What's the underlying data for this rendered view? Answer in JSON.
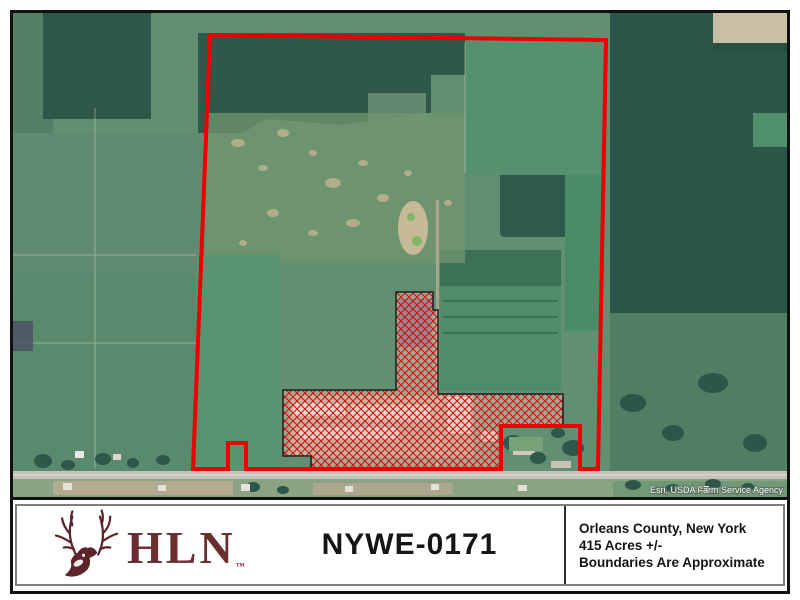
{
  "map": {
    "attribution": "Esri, USDA Farm Service Agency",
    "boundary_color": "#ee0000",
    "hatch_line_color": "#c51414",
    "hatch_fill_tint": "#f3c0ae",
    "hatch_outline_color": "#1c1c1c"
  },
  "footer": {
    "logo": {
      "text": "HLN",
      "trademark": "™",
      "color": "#5c2429",
      "deer_icon": "whitetail-buck-head"
    },
    "title": "NYWE-0171",
    "details": {
      "county": "Orleans County, New York",
      "acreage": "415 Acres +/-",
      "disclaimer": "Boundaries Are Approximate"
    }
  }
}
